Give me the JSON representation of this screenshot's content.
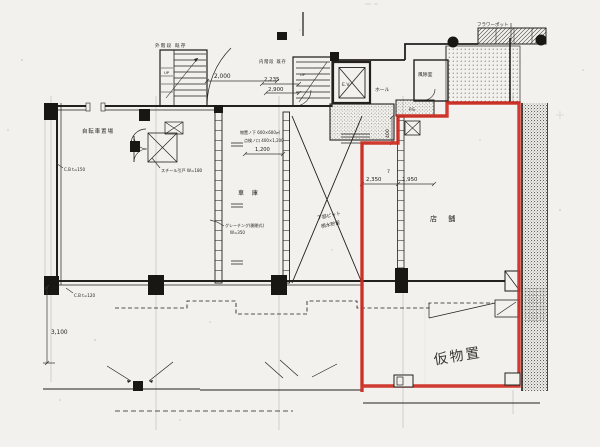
{
  "drawing": {
    "colors": {
      "paper": "#f2f1ed",
      "ink": "#23211e",
      "highlight_red": "#ce2a20"
    },
    "highlight": {
      "name": "tenant-area-outline",
      "color": "#ce2a20"
    },
    "labels": {
      "flower_pot": "フラワーポット",
      "stair_left": "外階段 既存",
      "stair_right": "内階段 既存",
      "up": "UP",
      "elevator": "E.V",
      "hall": "ホール",
      "windbreak": "風除室",
      "pipe_shaft": "P.S",
      "bicycle": "自転車置場",
      "garage": "車 庫",
      "shop": "店 舗",
      "pit_line1": "下部ピット",
      "pit_line2": "雨水貯留",
      "storage_note": "仮物置",
      "cb_150": "C.B t=150",
      "cb_120": "C.B t=120",
      "steel_door": "スチール引戸 W=180",
      "note_line1": "物置ノ下 600×600㎡",
      "note_line2": "点検ノ口 400×1,200",
      "grating_line1": "グレーチング(開閉式)",
      "grating_line2": "W=350"
    },
    "dimensions": {
      "w_2000": "2,000",
      "w_2235": "2,235",
      "w_2900": "2,900",
      "w_1200": "1,200",
      "w_2350": "2,350",
      "w_1950": "1,950",
      "h_400": "400",
      "n_7": "7",
      "h_3100": "3,100"
    }
  }
}
